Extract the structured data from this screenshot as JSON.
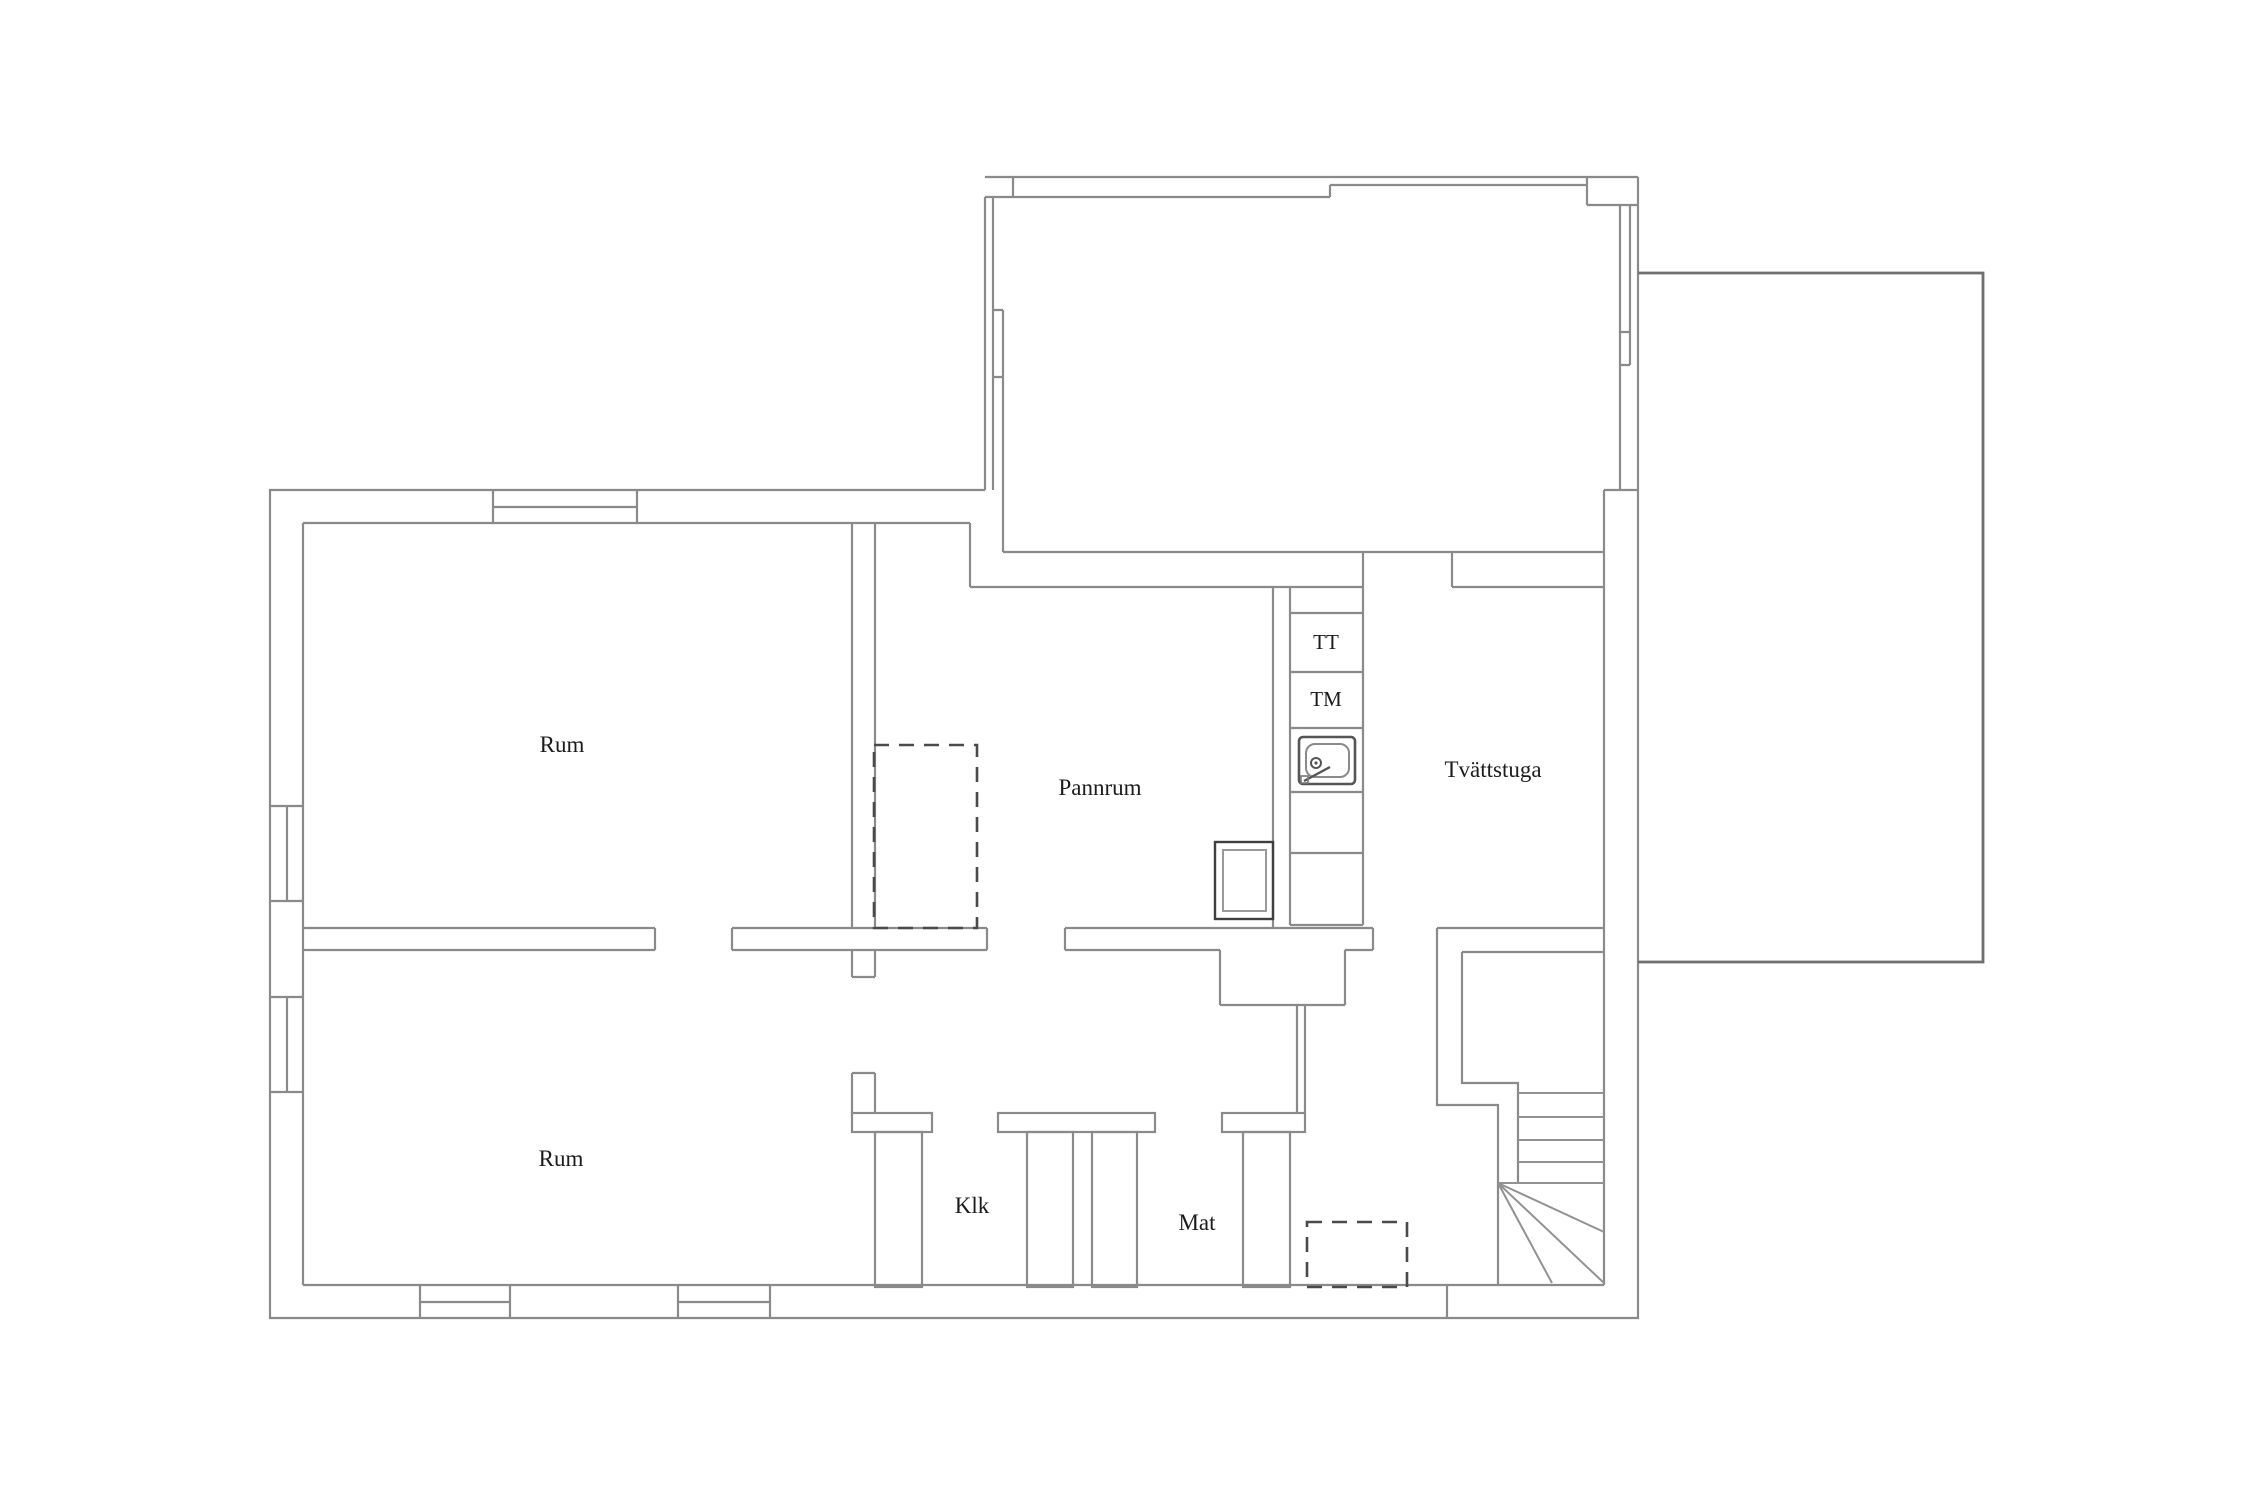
{
  "page": {
    "background": "#ffffff",
    "title": "Floor plan"
  },
  "plan": {
    "type": "floor-plan",
    "floor": "basement",
    "rooms": [
      {
        "id": "rum-upper",
        "label": "Rum"
      },
      {
        "id": "rum-lower",
        "label": "Rum"
      },
      {
        "id": "pannrum",
        "label": "Pannrum"
      },
      {
        "id": "tvattstuga",
        "label": "Tvättstuga"
      },
      {
        "id": "klk",
        "label": "Klk"
      },
      {
        "id": "mat",
        "label": "Mat"
      }
    ],
    "appliances": [
      {
        "id": "tt",
        "label": "TT"
      },
      {
        "id": "tm",
        "label": "TM"
      },
      {
        "id": "sink",
        "label": "sink"
      }
    ],
    "colors": {
      "wall": "#8a8a8a",
      "outline_dark": "#6f6f6f",
      "stair": "#929292",
      "dash": "#4a4a4a",
      "box_dark": "#3f3f3f",
      "fixture": "#9a9a9a",
      "text": "#1b1b1b"
    }
  }
}
